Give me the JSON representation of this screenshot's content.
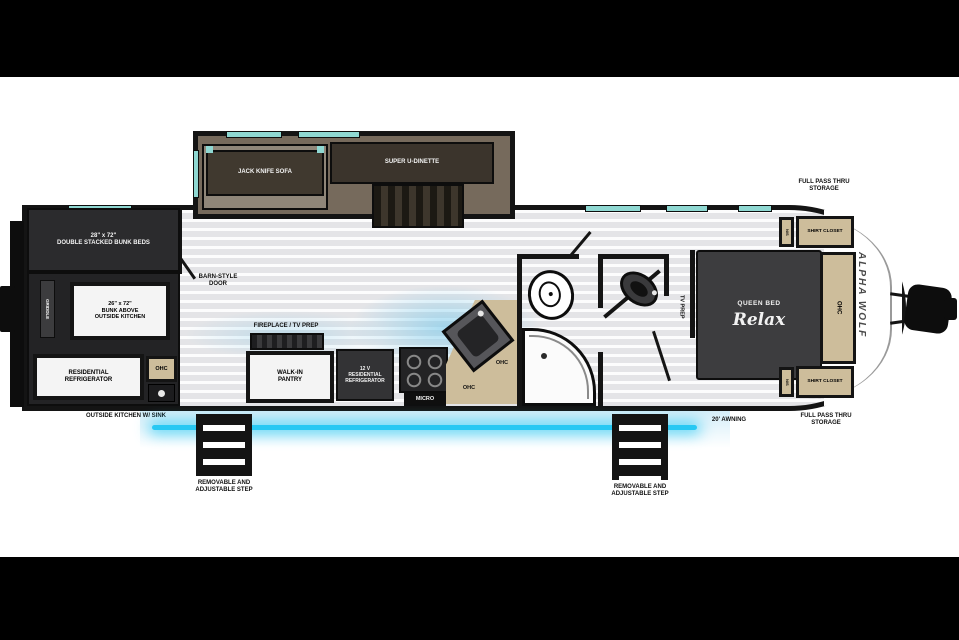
{
  "colors": {
    "wall": "#141414",
    "floor": "#e4e4e7",
    "slidefloor": "#766a5c",
    "countertan": "#cdbd9b",
    "windowteal": "#8fd8d2",
    "awningcyan": "#27c8f3",
    "darkfurn": "#343436"
  },
  "labels": {
    "jack_knife_sofa": "JACK KNIFE SOFA",
    "super_u_dinette": "SUPER U-DINETTE",
    "double_bunks": "28\" x 72\"\nDOUBLE STACKED BUNK BEDS",
    "bunk_above": "26\" x 72\"\nBUNK ABOVE\nOUTSIDE KITCHEN",
    "griddle": "GRIDDLE",
    "barn_door": "BARN-STYLE\nDOOR",
    "residential_refrigerator": "RESIDENTIAL\nREFRIGERATOR",
    "ohc": "OHC",
    "outside_kitchen": "OUTSIDE KITCHEN W/ SINK",
    "fireplace_tv_prep": "FIREPLACE / TV PREP",
    "walk_in_pantry": "WALK-IN\nPANTRY",
    "refrigerator_12v": "12 V\nRESIDENTIAL\nREFRIGERATOR",
    "micro": "MICRO",
    "tv_prep": "TV PREP",
    "queen_bed": "QUEEN BED",
    "relax": "Relax",
    "ns": "N/S",
    "shirt_closet": "SHIRT CLOSET",
    "full_pass_thru": "FULL PASS THRU\nSTORAGE",
    "awning": "20' AWNING",
    "step": "REMOVABLE AND\nADJUSTABLE STEP",
    "brand": "ALPHA WOLF"
  }
}
